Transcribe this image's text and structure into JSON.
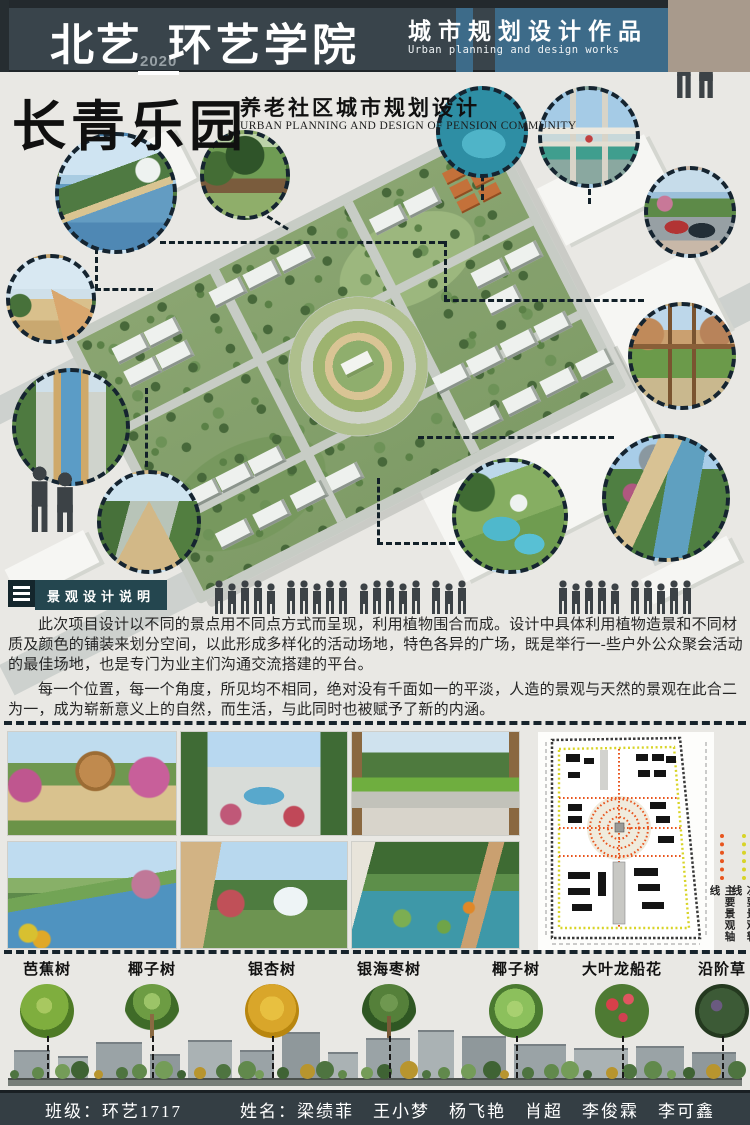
{
  "header": {
    "brand": "北艺",
    "year": "2020",
    "college": "环艺学院",
    "category_zh": "城市规划设计作品",
    "category_en": "Urban planning and design works"
  },
  "title": {
    "name": "长青乐园",
    "subtitle_zh": "养老社区城市规划设计",
    "subtitle_en": "URBAN PLANNING AND DESIGN OF PENSION COMMUNITY"
  },
  "description": {
    "heading": "景观设计说明",
    "paragraph1": "此次项目设计以不同的景点用不同点方式而呈现，利用植物围合而成。设计中具体利用植物造景和不同材质及颜色的铺装来划分空间，以此形成多样化的活动场地，特色各异的广场，既是举行一-些户外公众聚会活动的最佳场地，也是专门为业主们沟通交流搭建的平台。",
    "paragraph2": "每一个位置，每一个角度，所见均不相同，绝对没有千面如一的平淡，人造的景观与天然的景观在此合二为一，成为崭新意义上的自然，而生活，与此同时也被赋予了新的内涵。"
  },
  "site_plan": {
    "legend": [
      {
        "label": "主要景观轴线",
        "color": "#e8551e"
      },
      {
        "label": "次要景观轴线",
        "color": "#d8d428"
      }
    ]
  },
  "plants": {
    "labels": [
      "芭蕉树",
      "椰子树",
      "银杏树",
      "银海枣树",
      "椰子树",
      "大叶龙船花",
      "沿阶草"
    ]
  },
  "footer": {
    "class_label": "班级：",
    "class_value": "环艺1717",
    "name_label": "姓名：",
    "names": [
      "梁绩菲",
      "王小梦",
      "杨飞艳",
      "肖超",
      "李俊霖",
      "李可鑫"
    ]
  },
  "icons": {
    "menu": "hamburger-lines",
    "people": "person-silhouette"
  },
  "colors": {
    "header_dark": "#39444b",
    "header_blue": "#3d6b89",
    "header_tan": "#a89a8c",
    "body_bg": "#e9e8e4",
    "footer_bg": "#343e44"
  }
}
